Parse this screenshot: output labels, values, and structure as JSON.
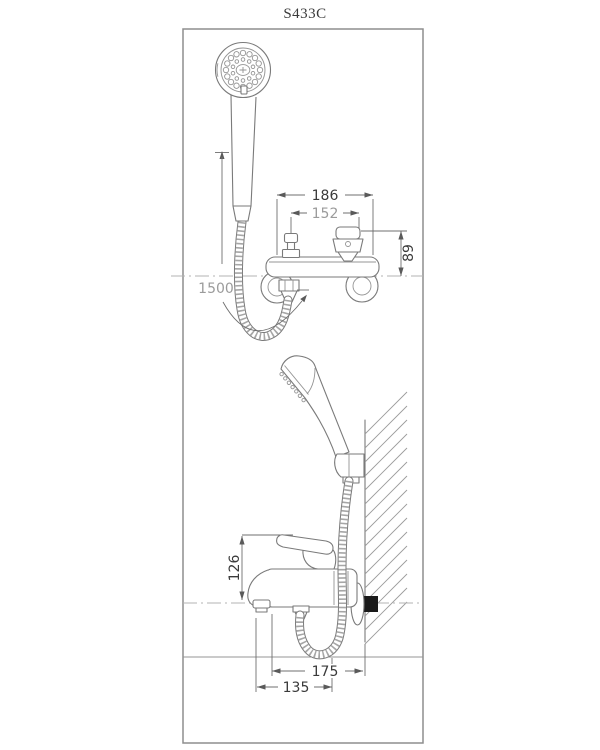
{
  "title": "S433C",
  "views": {
    "front": {
      "dim_width_outer_mm": "186",
      "dim_width_inner_mm": "152",
      "dim_height_mm": "89",
      "hose_length_mm": "1500"
    },
    "side": {
      "dim_spout_height_mm": "126",
      "dim_depth_outer_mm": "175",
      "dim_depth_inner_mm": "135"
    }
  },
  "colors": {
    "background": "#ffffff",
    "line_gray": "#7a7a7a",
    "frame_gray": "#8e8e8e",
    "text_dark": "#3a3a3a",
    "text_gray": "#9b9b9b",
    "mount_black": "#1a1a1a"
  }
}
